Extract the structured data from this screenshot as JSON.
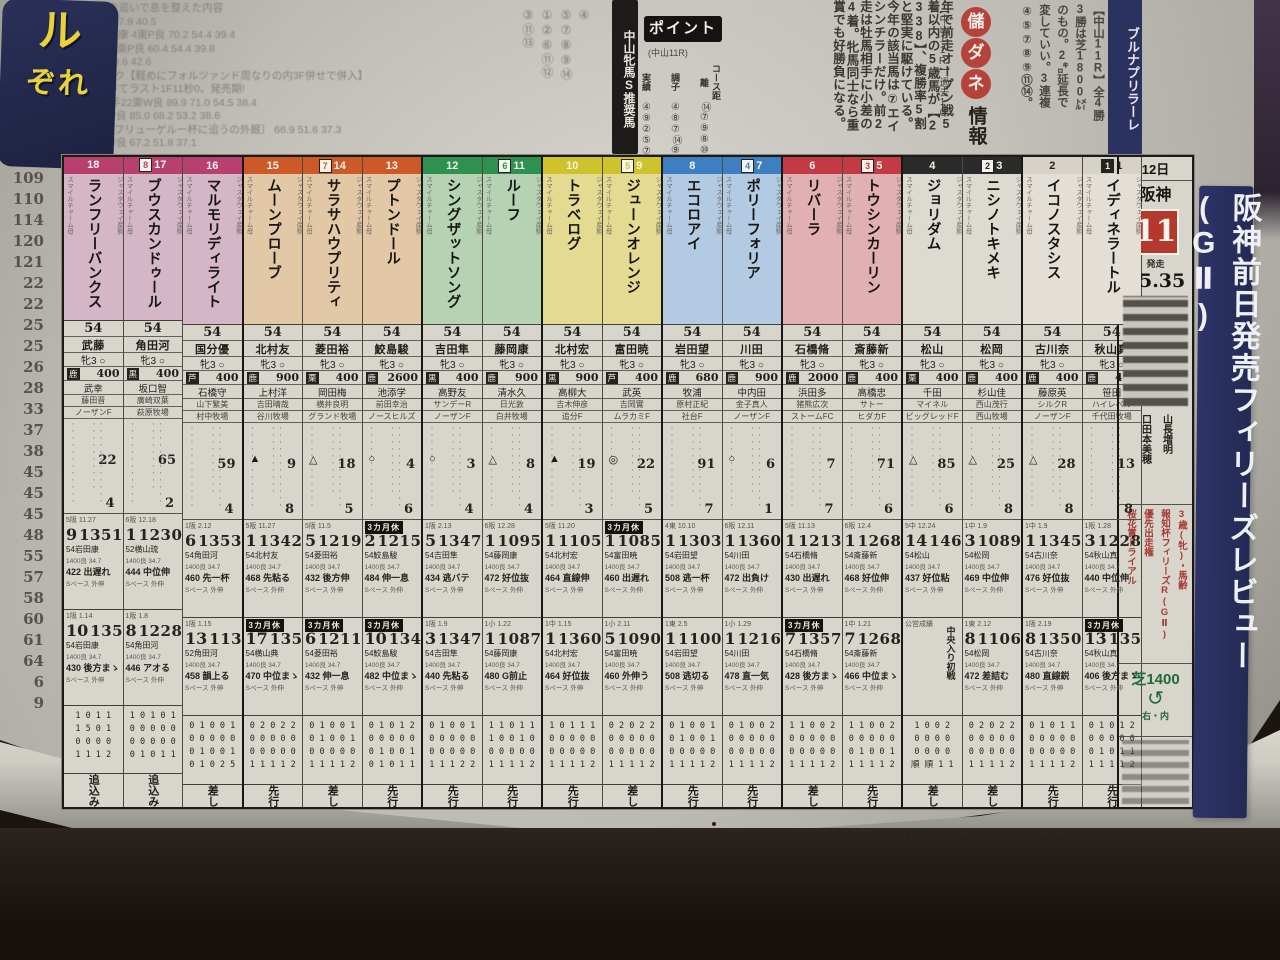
{
  "photo": {
    "paper_color": "#d3d0c8",
    "background": "#1b1511",
    "headline_box_color": "#232a55",
    "accent_red": "#b5382f",
    "accent_navy": "#2e3468",
    "accent_green": "#1e6b38"
  },
  "top": {
    "gutter_numbers": [
      "4",
      "7",
      "8",
      "2",
      "1",
      "9.9",
      "101",
      "101",
      "109",
      "110",
      "114",
      "120",
      "121",
      "22",
      "22",
      "25",
      "25",
      "26",
      "28",
      "33",
      "37",
      "38",
      "45",
      "45",
      "45",
      "48",
      "55",
      "57",
      "58",
      "60",
      "61",
      "64",
      "6",
      "9"
    ],
    "training_lines": [
      "入厩日併走追いで息を整えた内容",
      "87.2  78.5  57.9  40.5",
      "(内併) 藤岡康 4東P良  70.2  54.4  39.4",
      "馬場先週 7栗P良  60.4  54.4  39.8",
      "15週2勝  60.6  42.6",
      "●ウインピク【軽めにフォルツァンド周なりの内3F併せで併入】",
      "直線に伸びてラスト1F11秒0、発売期!",
      "(外併) 助 手22栗W良 89.9 71.0 54.5 38.4",
      "助 手1栗W良 85.0 68.2 53.2 38.6",
      "〔3歳未勝フリューゲルー杯に追うの外厩〕 66.9 51.6 37.3",
      "助 手8栗W良 67.2 51.8 37.1"
    ],
    "suisho_number_cols": [
      "③⑪⑬",
      "①②⑥⑪⑫",
      "⑤⑦⑧⑨⑭",
      "④"
    ],
    "suisho_banner": "中山牝馬S推奨馬",
    "point": {
      "title": "ポイント",
      "sub": "(中山11R)",
      "rows": [
        {
          "label": "実績",
          "vals": "④⑨②⑤⑦"
        },
        {
          "label": "調子",
          "vals": "④⑧⑦⑭⑨"
        },
        {
          "label": "コース距離",
          "vals": "⑭⑦⑨⑧⑩"
        }
      ]
    },
    "article_cols": [
      "年で前走オープン戦5",
      "着以内の5歳馬が【2",
      "338】、複勝率5割",
      "と堅実に駆けている。",
      "今年の該当馬は⑦エイ",
      "シンチラーだけ。前2",
      "走は牡馬相手に小差の",
      "4着。牝馬同士なら重",
      "賞でも好勝負になる。"
    ],
    "moukedane": {
      "circles": [
        "儲",
        "ダ",
        "ネ"
      ],
      "suffix": "情報",
      "lead": "【中山11R】過去10"
    },
    "right_cols": [
      "【中山11R】全4勝",
      "3勝は芝1800㍍",
      "のもの。2㌔延長で",
      "変していい。3連複",
      "④⑤⑦⑧⑨⑪⑭。"
    ],
    "headline_strip": "ブルナプリラーレ",
    "headline_box_top": "ル",
    "headline_box_bottom": "ぞれ"
  },
  "race": {
    "date": "12日",
    "track": "阪神",
    "number": "11",
    "start_label": "発走",
    "start_time": "15.35",
    "side_title": "阪神前日発売フィリーズレビュー(GⅡ)",
    "info_names": [
      "口田本美穂",
      "山長増明"
    ],
    "conditions_red": [
      "桜花賞トライアル",
      "優先出走権",
      "報知杯フィリーズR(GⅡ)",
      "3歳(牝)・馬齢"
    ],
    "course_dist": "芝1400",
    "course_dir": "右・内",
    "course_loop_icon": "loop-arrow"
  },
  "frames": {
    "w8": {
      "band": "#b8406e",
      "tint": "#d4b6c6",
      "digit": "8"
    },
    "w7": {
      "band": "#cc5a28",
      "tint": "#e2c8a6",
      "digit": "7"
    },
    "w6": {
      "band": "#2f9150",
      "tint": "#b5d3b3",
      "digit": "6"
    },
    "w5": {
      "band": "#cfc22a",
      "tint": "#e4da92",
      "digit": "5"
    },
    "w4": {
      "band": "#3d7fc1",
      "tint": "#b3cbe2",
      "digit": "4"
    },
    "w3": {
      "band": "#c23a44",
      "tint": "#e0b0b2",
      "digit": "3"
    },
    "w2": {
      "band": "#2b2b2b",
      "tint": "#dddad2",
      "digit": "2"
    },
    "w1": {
      "band": "#d6d2c8",
      "tint": "#e3dfd6",
      "digit": "1",
      "dark_text": true
    }
  },
  "horses": [
    {
      "n": "18",
      "f": "w8",
      "name": "ランフリーバンクス",
      "jockey": "武藤",
      "sexage": "牝3",
      "coat": "鹿",
      "prize": "400",
      "trainer": "武幸",
      "owner": "藤田晋",
      "farm": "ノーザンF",
      "m1": "22",
      "m2": "4",
      "tri": "",
      "r1": {
        "h": "5阪 11.27",
        "pos": "9",
        "time": "1351",
        "j": "54岩田康",
        "w": "422 出遅れ"
      },
      "r2": {
        "h": "1阪 1.14",
        "pos": "10",
        "time": "1355",
        "j": "54岩田康",
        "w": "430 後方まゝ"
      },
      "rec": [
        "1 0 1 1",
        "1 5 0 1",
        "0 0 0 0",
        "1 1 1 2"
      ],
      "style": "追込み"
    },
    {
      "n": "17",
      "wb": true,
      "f": "w8",
      "name": "ブウスカンドゥール",
      "jockey": "角田河",
      "sexage": "牝3",
      "coat": "黒",
      "prize": "400",
      "trainer": "坂口智",
      "owner": "廣崎双葉",
      "farm": "萩原牧場",
      "m1": "65",
      "m2": "2",
      "tri": "",
      "r1": {
        "h": "6阪 12.18",
        "pos": "1",
        "time": "1230",
        "j": "52横山琉",
        "w": "444 中位伸"
      },
      "r2": {
        "h": "1阪 1.8",
        "pos": "8",
        "time": "1228",
        "j": "54角田河",
        "w": "446 アオる"
      },
      "rec": [
        "1 0 1 0 1",
        "0 0 0 0 0",
        "0 0 0 0 0",
        "0 1 0 1 1"
      ],
      "style": "追込み"
    },
    {
      "n": "16",
      "f": "w8",
      "gsep": true,
      "name": "マルモリディライト",
      "jockey": "国分優",
      "sexage": "牝3",
      "coat": "芦",
      "prize": "400",
      "trainer": "石橋守",
      "owner": "山下繁美",
      "farm": "村中牧場",
      "m1": "59",
      "m2": "4",
      "tri": "",
      "r1": {
        "h": "1阪 2.12",
        "pos": "6",
        "time": "1353",
        "j": "54角田河",
        "w": "460 先一杯"
      },
      "r2": {
        "h": "1阪 1.15",
        "pos": "13",
        "time": "1139",
        "j": "52角田河",
        "w": "458 韻上る"
      },
      "rec": [
        "0 1 0 0 1",
        "0 0 0 0 0",
        "0 1 0 0 1",
        "0 1 0 2 5"
      ],
      "style": "差し"
    },
    {
      "n": "15",
      "f": "w7",
      "name": "ムーンプローブ",
      "jockey": "北村友",
      "sexage": "牝3",
      "coat": "鹿",
      "prize": "900",
      "trainer": "上村洋",
      "owner": "吉田晴哉",
      "farm": "谷川牧場",
      "m1": "9",
      "m2": "8",
      "tri": "▲",
      "r1": {
        "h": "5阪 11.27",
        "pos": "1",
        "time": "1342",
        "j": "54北村友",
        "w": "468 先粘る"
      },
      "r2": {
        "h": "1中 1.9",
        "pos": "17",
        "time": "1359",
        "j": "54横山典",
        "w": "470 中位まゝ",
        "badge": "3カ月休"
      },
      "rec": [
        "0 2 0 2 2",
        "0 0 0 0 0",
        "0 0 0 0 0",
        "1 1 1 1 2"
      ],
      "style": "先行"
    },
    {
      "n": "14",
      "wb": true,
      "f": "w7",
      "name": "サラサハウプリティ",
      "jockey": "菱田裕",
      "sexage": "牝3",
      "coat": "栗",
      "prize": "400",
      "trainer": "岡田梅",
      "owner": "横井良明",
      "farm": "グランド牧場",
      "m1": "18",
      "m2": "5",
      "tri": "△",
      "r1": {
        "h": "5阪 11.5",
        "pos": "5",
        "time": "1219",
        "j": "54菱田裕",
        "w": "432 後方伸"
      },
      "r2": {
        "h": "1阪 2.4",
        "pos": "6",
        "time": "1211",
        "j": "54菱田裕",
        "w": "432 伸一息",
        "badge": "3カ月休"
      },
      "rec": [
        "0 1 0 0 1",
        "0 1 0 0 1",
        "0 0 0 0 0",
        "1 1 1 1 2"
      ],
      "style": "差し"
    },
    {
      "n": "13",
      "f": "w7",
      "gsep": true,
      "name": "プトンドール",
      "jockey": "鮫島駿",
      "sexage": "牝3",
      "coat": "鹿",
      "prize": "2600",
      "trainer": "池添学",
      "owner": "前田幸治",
      "farm": "ノースヒルズ",
      "m1": "4",
      "m2": "6",
      "tri": "○",
      "r1": {
        "h": "4阪 10.22",
        "pos": "2",
        "time": "1215",
        "j": "54鮫島駿",
        "w": "484 伸一息",
        "badge": "3カ月休"
      },
      "r2": {
        "h": "1小 2.5",
        "pos": "10",
        "time": "1347",
        "j": "54鮫島駿",
        "w": "482 中位まゝ",
        "badge": "3カ月休"
      },
      "rec": [
        "0 1 0 1 2",
        "0 0 0 0 0",
        "0 1 0 0 1",
        "0 1 0 1 1"
      ],
      "style": "先行"
    },
    {
      "n": "12",
      "f": "w6",
      "name": "シングザットソング",
      "jockey": "吉田隼",
      "sexage": "牝3",
      "coat": "黒",
      "prize": "400",
      "trainer": "高野友",
      "owner": "サンデーR",
      "farm": "ノーザンF",
      "m1": "3",
      "m2": "4",
      "tri": "○",
      "r1": {
        "h": "1阪 2.13",
        "pos": "5",
        "time": "1347",
        "j": "54吉田隼",
        "w": "434 逃バテ"
      },
      "r2": {
        "h": "1阪 1.9",
        "pos": "3",
        "time": "1347",
        "j": "54吉田隼",
        "w": "440 先粘る"
      },
      "rec": [
        "0 1 0 0 1",
        "0 0 0 0 0",
        "0 0 0 0 0",
        "1 1 1 2 2"
      ],
      "style": "先行"
    },
    {
      "n": "11",
      "wb": true,
      "f": "w6",
      "gsep": true,
      "name": "ルーフ",
      "jockey": "藤岡康",
      "sexage": "牝3",
      "coat": "鹿",
      "prize": "900",
      "trainer": "清水久",
      "owner": "日光敦",
      "farm": "白井牧場",
      "m1": "8",
      "m2": "4",
      "tri": "△",
      "r1": {
        "h": "6阪 12.28",
        "pos": "1",
        "time": "1095",
        "j": "54藤岡康",
        "w": "472 好位抜"
      },
      "r2": {
        "h": "1小 1.22",
        "pos": "1",
        "time": "1087",
        "j": "54藤岡康",
        "w": "480 G前止"
      },
      "rec": [
        "1 1 0 1 1",
        "1 0 0 1 0",
        "0 0 0 0 0",
        "1 1 1 1 2"
      ],
      "style": "先行"
    },
    {
      "n": "10",
      "f": "w5",
      "name": "トラベログ",
      "jockey": "北村宏",
      "sexage": "牝3",
      "coat": "黒",
      "prize": "900",
      "trainer": "高柳大",
      "owner": "吉木伸彦",
      "farm": "追分F",
      "m1": "19",
      "m2": "3",
      "tri": "▲",
      "r1": {
        "h": "5阪 11.20",
        "pos": "1",
        "time": "1105",
        "j": "54北村宏",
        "w": "464 直線伸"
      },
      "r2": {
        "h": "1中 1.15",
        "pos": "1",
        "time": "1360",
        "j": "54北村宏",
        "w": "464 好位抜"
      },
      "rec": [
        "1 0 1 1 1",
        "0 0 0 0 0",
        "0 0 0 0 0",
        "1 1 1 1 2"
      ],
      "style": "先行"
    },
    {
      "n": "9",
      "wb": true,
      "f": "w5",
      "gsep": true,
      "name": "ジューンオレンジ",
      "jockey": "富田暁",
      "sexage": "牝3",
      "coat": "芦",
      "prize": "400",
      "trainer": "武英",
      "owner": "吉岡實",
      "farm": "ムラカミF",
      "m1": "22",
      "m2": "5",
      "tri": "◎",
      "r1": {
        "h": "5阪 11.27",
        "pos": "1",
        "time": "1085",
        "j": "54富田暁",
        "w": "460 出遅れ",
        "badge": "3カ月休"
      },
      "r2": {
        "h": "1小 2.11",
        "pos": "5",
        "time": "1090",
        "j": "54富田暁",
        "w": "460 外伸う"
      },
      "rec": [
        "0 2 0 2 2",
        "0 0 0 0 0",
        "0 0 0 0 0",
        "1 1 1 1 2"
      ],
      "style": "差し"
    },
    {
      "n": "8",
      "f": "w4",
      "name": "エコロアイ",
      "jockey": "岩田望",
      "sexage": "牝3",
      "coat": "鹿",
      "prize": "680",
      "trainer": "牧浦",
      "owner": "原村正紀",
      "farm": "社台F",
      "m1": "91",
      "m2": "7",
      "tri": "",
      "r1": {
        "h": "4東 10.10",
        "pos": "1",
        "time": "1303",
        "j": "54岩田望",
        "w": "508 逃一杯"
      },
      "r2": {
        "h": "1東 2.5",
        "pos": "1",
        "time": "1100",
        "j": "54岩田望",
        "w": "508 逃切る"
      },
      "rec": [
        "0 1 0 0 1",
        "0 1 0 0 1",
        "0 0 0 0 0",
        "1 1 1 1 2"
      ],
      "style": "先行"
    },
    {
      "n": "7",
      "wb": true,
      "f": "w4",
      "gsep": true,
      "name": "ポリーフォリア",
      "jockey": "川田",
      "sexage": "牝3",
      "coat": "鹿",
      "prize": "900",
      "trainer": "中内田",
      "owner": "金子真人",
      "farm": "ノーザンF",
      "m1": "6",
      "m2": "1",
      "tri": "○",
      "r1": {
        "h": "6阪 12.11",
        "pos": "1",
        "time": "1360",
        "j": "54川田",
        "w": "472 出負け"
      },
      "r2": {
        "h": "1小 1.29",
        "pos": "1",
        "time": "1216",
        "j": "54川田",
        "w": "478 直一気"
      },
      "rec": [
        "0 1 0 0 2",
        "0 0 0 0 0",
        "0 0 0 0 0",
        "1 1 1 1 2"
      ],
      "style": "先行"
    },
    {
      "n": "6",
      "f": "w3",
      "name": "リバーラ",
      "jockey": "石橋脩",
      "sexage": "牝3",
      "coat": "鹿",
      "prize": "2000",
      "trainer": "浜田多",
      "owner": "猪熊広次",
      "farm": "ストームFC",
      "m1": "7",
      "m2": "7",
      "tri": "",
      "r1": {
        "h": "5阪 11.13",
        "pos": "1",
        "time": "1213",
        "j": "54石橋脩",
        "w": "430 出遅れ"
      },
      "r2": {
        "h": "1小 1.14",
        "pos": "7",
        "time": "1357",
        "j": "54石橋脩",
        "w": "428 後方まゝ",
        "badge": "3カ月休"
      },
      "rec": [
        "1 1 0 0 2",
        "0 0 0 0 0",
        "0 0 0 0 0",
        "1 1 1 1 2"
      ],
      "style": "差し"
    },
    {
      "n": "5",
      "wb": true,
      "f": "w3",
      "gsep": true,
      "name": "トウシンカーリン",
      "jockey": "斎藤新",
      "sexage": "牝3",
      "coat": "鹿",
      "prize": "400",
      "trainer": "高橋忠",
      "owner": "サトー",
      "farm": "ヒダカF",
      "m1": "71",
      "m2": "6",
      "tri": "",
      "r1": {
        "h": "6阪 12.4",
        "pos": "1",
        "time": "1268",
        "j": "54斎藤新",
        "w": "468 好位伸"
      },
      "r2": {
        "h": "1中 1.21",
        "pos": "7",
        "time": "1268",
        "j": "54斎藤新",
        "w": "466 中位まゝ"
      },
      "rec": [
        "1 1 0 0 2",
        "0 0 0 0 0",
        "0 1 0 0 1",
        "1 1 1 1 2"
      ],
      "style": "先行"
    },
    {
      "n": "4",
      "f": "w2",
      "name": "ジョリダム",
      "jockey": "松山",
      "sexage": "牝3",
      "coat": "栗",
      "prize": "400",
      "trainer": "千田",
      "owner": "マイネル",
      "farm": "ビッグレッドF",
      "m1": "85",
      "m2": "6",
      "tri": "△",
      "r1": {
        "h": "5中 12.24",
        "pos": "14",
        "time": "1461",
        "j": "54松山",
        "w": "437 好位粘"
      },
      "r2": {
        "h": "公営成績",
        "pos": "",
        "time": "",
        "j": "",
        "w": "",
        "note": "中央入り初戦"
      },
      "rec": [
        "1 0 0 2",
        "0 0 0 0",
        "0 0 0 0",
        "順 順 1 1"
      ],
      "style": "差し"
    },
    {
      "n": "3",
      "wb": true,
      "f": "w2",
      "gsep": true,
      "name": "ニシノトキメキ",
      "jockey": "松岡",
      "sexage": "牝3",
      "coat": "鹿",
      "prize": "400",
      "trainer": "杉山佳",
      "owner": "西山茂行",
      "farm": "西山牧場",
      "m1": "25",
      "m2": "8",
      "tri": "△",
      "r1": {
        "h": "1中 1.9",
        "pos": "3",
        "time": "1089",
        "j": "54松岡",
        "w": "469 中位伸"
      },
      "r2": {
        "h": "1東 2.12",
        "pos": "8",
        "time": "1106",
        "j": "54松岡",
        "w": "472 差詰む"
      },
      "rec": [
        "0 2 0 2 2",
        "0 0 0 0 0",
        "0 0 0 0 0",
        "1 1 1 1 2"
      ],
      "style": "差し"
    },
    {
      "n": "2",
      "f": "w1",
      "name": "イコノスタシス",
      "jockey": "古川奈",
      "sexage": "牝3",
      "coat": "鹿",
      "prize": "400",
      "trainer": "藤原英",
      "owner": "シルクR",
      "farm": "ノーザンF",
      "m1": "28",
      "m2": "8",
      "tri": "△",
      "r1": {
        "h": "1中 1.9",
        "pos": "1",
        "time": "1345",
        "j": "54古川奈",
        "w": "476 好位抜"
      },
      "r2": {
        "h": "1阪 2.19",
        "pos": "8",
        "time": "1350",
        "j": "54古川奈",
        "w": "480 直線鋭"
      },
      "rec": [
        "0 1 0 1 1",
        "0 0 0 0 0",
        "0 0 0 0 0",
        "1 1 1 1 2"
      ],
      "style": "先行"
    },
    {
      "n": "1",
      "wb": true,
      "f": "w1",
      "name": "イディネラートル",
      "jockey": "秋山真",
      "sexage": "牝3",
      "coat": "鹿",
      "prize": "400",
      "trainer": "笹田",
      "owner": "ハイレベル",
      "farm": "千代田牧場",
      "m1": "13",
      "m2": "8",
      "tri": "",
      "r1": {
        "h": "1阪 1.28",
        "pos": "3",
        "time": "1228",
        "j": "54秋山真",
        "w": "440 中位伸"
      },
      "r2": {
        "h": "1阪 2.18",
        "pos": "13",
        "time": "1350",
        "j": "54秋山真",
        "w": "406 後方まゝ",
        "badge": "3カ月休"
      },
      "rec": [
        "0 1 0 1 2",
        "0 0 0 0 0",
        "0 1 0 1 1",
        "1 1 1 1 2"
      ],
      "style": "先行"
    }
  ]
}
